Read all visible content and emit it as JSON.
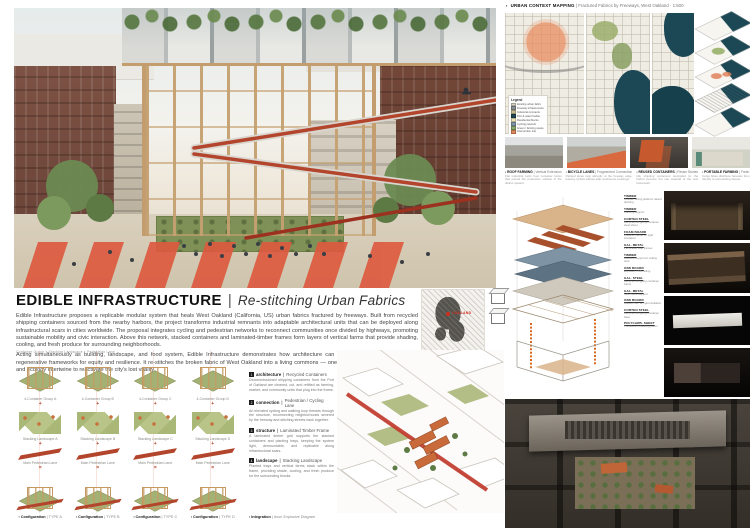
{
  "sep": "|",
  "title_block": {
    "title": "EDIBLE INFRASTRUCTURE",
    "subtitle": "Re-stitching Urban Fabrics",
    "paragraph_1": "Edible Infrastructure proposes a replicable modular system that heals West Oakland (California, US) urban fabrics fractured by freeways. Built from recycled shipping containers sourced from the nearby harbors, the project transforms industrial remnants into adaptable architectural units that can be deployed along infrastructural scars in cities worldwide. The proposal integrates cycling and pedestrian networks to reconnect communities once divided by highways, promoting sustainable mobility and civic interaction. Above this network, stacked containers and laminated-timber frames form layers of vertical farms that provide shading, cooling, and fresh produce for surrounding neighborhoods.",
    "paragraph_2": "Acting simultaneously as building, landscape, and food system, Edible Infrastructure demonstrates how architecture can convert urban by-products into regenerative frameworks for equity and resilience. It re-stitches the broken fabric of West Oakland into a living commons — one where movement, nourishment, and ecology intertwine to reactivate the city's lost vitality."
  },
  "location": {
    "city_label": "OAKLAND"
  },
  "context_mapping": {
    "header_title": "URBAN CONTEXT MAPPING",
    "header_subtitle": "Fractured Fabrics by Freeways, West Oakland · 1:500",
    "legend": {
      "title": "Legend",
      "items": [
        {
          "label": "Existing urban fabric",
          "color": "#d9d3c6"
        },
        {
          "label": "Freeway infrastructure",
          "color": "#8a8f93"
        },
        {
          "label": "Industrial remnants",
          "color": "#c9bd93"
        },
        {
          "label": "Port & water bodies",
          "color": "#1c4856"
        },
        {
          "label": "Residential blocks",
          "color": "#efe6b8"
        },
        {
          "label": "Cycling network",
          "color": "#7d98a8"
        },
        {
          "label": "Green / farming space",
          "color": "#8aa86b"
        },
        {
          "label": "Intervention site",
          "color": "#e08a5a"
        }
      ]
    },
    "analysis_panels": [
      {
        "title": "ROOF FARMING",
        "subtitle": "Vertical Extension",
        "caption": "Flat industrial roofs host container farms that extend the productive surface of the district upward."
      },
      {
        "title": "BICYCLE LANES",
        "subtitle": "Fragmented Connection",
        "caption": "Painted lanes stop abruptly at the freeway edge, leaving cyclists without safe continuous crossings."
      },
      {
        "title": "REUSED CONTAINERS",
        "subtitle": "Reuse Stories",
        "caption": "Idle shipping containers stockpiled by the harbor become the raw material of the new framework."
      },
      {
        "title": "PORTABLE FARMING",
        "subtitle": "Fresh Produce Delivery",
        "caption": "Cargo bikes distribute harvests from the farming frames directly to surrounding streets."
      }
    ]
  },
  "materials": {
    "items": [
      {
        "name": "TIMBER",
        "desc": "Outdoor dining platform raised decking"
      },
      {
        "name": "TIMBER",
        "desc": "Framing support"
      },
      {
        "name": "CORTEN STEEL",
        "desc": "Recycled shipping container steel sheet"
      },
      {
        "name": "FOAM BOARD",
        "desc": "Weather barrier w/ rigid insulation"
      },
      {
        "name": "GAL. METAL",
        "desc": "Perforated side frames"
      },
      {
        "name": "TIMBER",
        "desc": "Cladded support w/ ceiling stud"
      },
      {
        "name": "OSB BOARD",
        "desc": "Exposed OSB ceiling"
      },
      {
        "name": "GAL. STEEL",
        "desc": "Recycled shipping container frame"
      },
      {
        "name": "GAL. METAL",
        "desc": "Side frame support"
      },
      {
        "name": "OSB BOARD",
        "desc": "Raised floor w/ rigid insulation"
      },
      {
        "name": "CORTEN STEEL",
        "desc": "Recycled shipping container base"
      },
      {
        "name": "POLYCARB. SHEET",
        "desc": "Translucent cladding panel"
      }
    ]
  },
  "configurations": {
    "note": "Container Group + Stacking Landscape + Pedestrian Lane",
    "plus": "+",
    "equals": "=",
    "columns": [
      {
        "group": "4-Container Group A",
        "landscape": "Stacking Landscape A",
        "lane": "Main Pedestrian Lane",
        "label_name": "Configuration",
        "label_detail": "TYPE A"
      },
      {
        "group": "4-Container Group B",
        "landscape": "Stacking Landscape B",
        "lane": "Main Pedestrian Lane",
        "label_name": "Configuration",
        "label_detail": "TYPE B"
      },
      {
        "group": "4-Container Group C",
        "landscape": "Stacking Landscape C",
        "lane": "Main Pedestrian Lane",
        "label_name": "Configuration",
        "label_detail": "TYPE C"
      },
      {
        "group": "4-Container Group D",
        "landscape": "Stacking Landscape D",
        "lane": "Main Pedestrian Lane",
        "label_name": "Configuration",
        "label_detail": "TYPE D"
      }
    ]
  },
  "systems": {
    "items": [
      {
        "index": "1",
        "name": "architecture",
        "subtitle": "Recycled Containers",
        "body": "Decommissioned shipping containers from the Port of Oakland are cleaned, cut, and refitted as farming, market, and community units that plug into the frame."
      },
      {
        "index": "2",
        "name": "connection",
        "subtitle": "Pedestrian / Cycling Lane",
        "body": "An elevated cycling and walking loop threads through the structure, reconnecting neighborhoods severed by the freeway and stitching streets back together."
      },
      {
        "index": "3",
        "name": "structure",
        "subtitle": "Laminated Timber Frame",
        "body": "A laminated timber grid supports the stacked containers and planting trays, keeping the system light, demountable, and replicable along infrastructural scars."
      },
      {
        "index": "4",
        "name": "landscape",
        "subtitle": "Stacking Landscape",
        "body": "Planted trays and vertical farms stack within the frame, providing shade, cooling, and fresh produce for the surrounding blocks."
      }
    ]
  },
  "integration": {
    "label_name": "Integration",
    "label_detail": "Axon Explosive Diagram"
  },
  "colors": {
    "accent_red": "#d95b41",
    "ramp_red": "#b3452c",
    "timber": "#c49d6e",
    "brick": "#74483a",
    "water_navy": "#1c4856",
    "foliage": "#6c8a52",
    "aerial_dark": "#332e28"
  }
}
